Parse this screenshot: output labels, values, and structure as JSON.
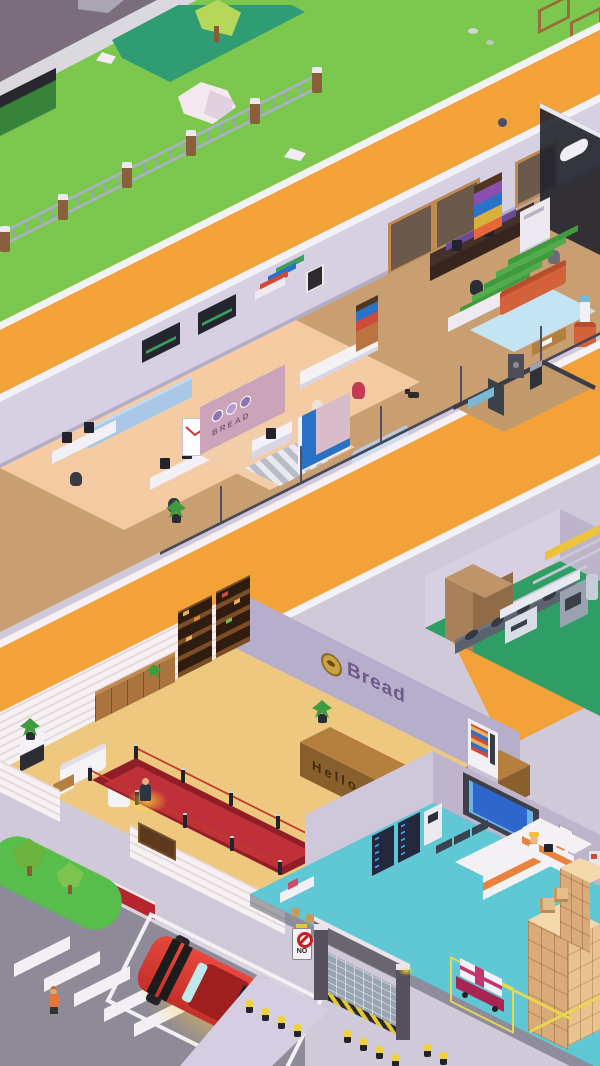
{
  "signs": {
    "bread_wall": "Bread",
    "reception_logo": "BREAD",
    "desk_greeting": "Hello",
    "loading_dock_no": "NO"
  },
  "palette": {
    "grass": "#7cc84f",
    "path_orange": "#f2a239",
    "road": "#8e8a98",
    "lobby_floor": "#eec87e",
    "office_floor": "#f5cba3",
    "wood_floor": "#c99e70",
    "warehouse_floor": "#5fc8d4",
    "factory_floor": "#2f9e66",
    "wall_light": "#d6d0e2",
    "wall_accent": "#b6aecb",
    "carpet_red": "#b7252e",
    "car_red": "#d93a31",
    "sofa_orange": "#d3613a",
    "boxes_tan": "#d9ab79",
    "planter_teal": "#2f9c74"
  },
  "icons": {
    "bread_badge_icon": "gold-bread-badge",
    "no_entry_icon": "red-prohibition-ring"
  }
}
